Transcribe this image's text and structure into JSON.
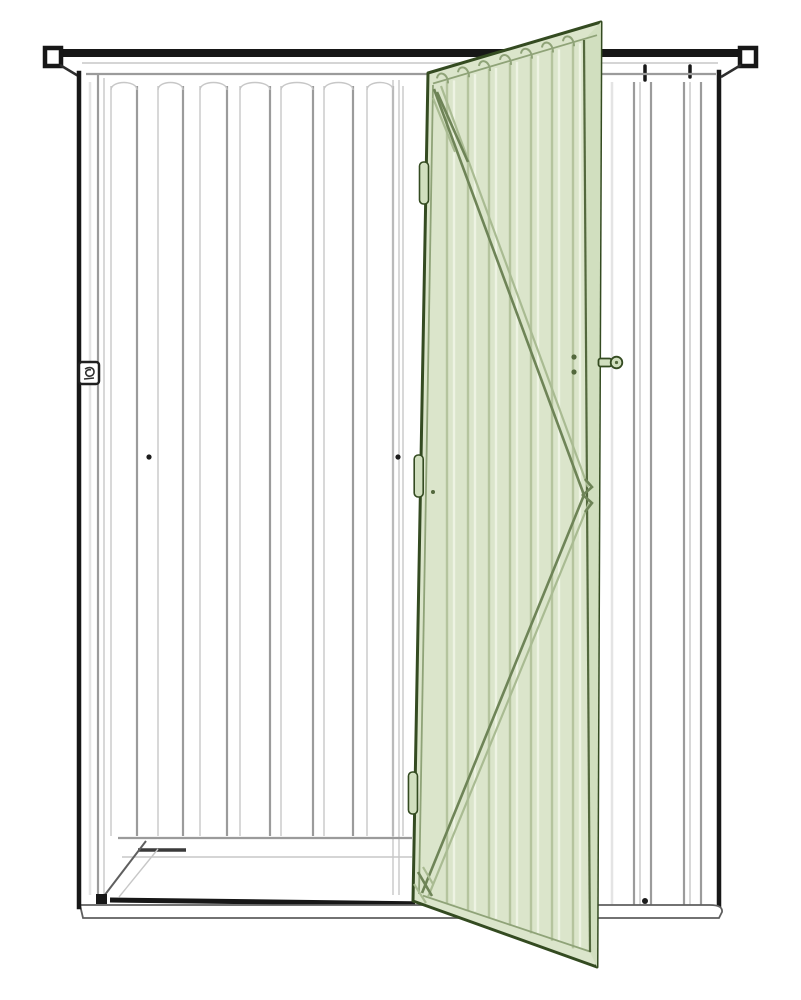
{
  "illustration": {
    "subject": "metal-garden-shed-front-view",
    "door_state": "open",
    "door_color_name": "sage-green",
    "style": "sketch-line-drawing"
  },
  "colors": {
    "paper": "#ffffff",
    "ink": "#171717",
    "line_faint": "#e4e4e4",
    "line_light": "#c7c7c7",
    "line_mid": "#9b9b9b",
    "line_dark": "#5f5f5f",
    "door_fill": "#dbe5cb",
    "door_edge_fill": "#d1dfbf",
    "door_outline": "#344b21",
    "door_stile": "#53683d",
    "door_rib": "#b5c49e",
    "door_rib_hi": "#eef3e3",
    "door_rib_dk": "#8fa378",
    "brace": "#6e8457",
    "brace_hi": "#a9bb92"
  },
  "geometry": {
    "canvas": {
      "width": 801,
      "height": 1000
    },
    "interior": {
      "rib_top_y": 86,
      "rib_bottom_y": 836,
      "ribs": [
        [
          111,
          1
        ],
        [
          137,
          2
        ],
        [
          158,
          1
        ],
        [
          183,
          2
        ],
        [
          200,
          1
        ],
        [
          227,
          2
        ],
        [
          240,
          1
        ],
        [
          270,
          2
        ],
        [
          281,
          1
        ],
        [
          313,
          2
        ],
        [
          324,
          1
        ],
        [
          353,
          2
        ],
        [
          367,
          1
        ],
        [
          393,
          2
        ],
        [
          403,
          1
        ]
      ],
      "arc_pairs": [
        [
          111,
          137
        ],
        [
          158,
          183
        ],
        [
          200,
          227
        ],
        [
          240,
          270
        ],
        [
          281,
          313
        ],
        [
          324,
          353
        ],
        [
          367,
          393
        ]
      ],
      "dots": [
        [
          149,
          457
        ],
        [
          398,
          457
        ]
      ]
    },
    "right_wall": {
      "rib_top_y": 82,
      "rib_bottom_y": 905,
      "ribs": [
        [
          612,
          0
        ],
        [
          634,
          2
        ],
        [
          640,
          1
        ],
        [
          651,
          2
        ],
        [
          684,
          2
        ],
        [
          690,
          1
        ],
        [
          701,
          2
        ]
      ],
      "top_ticks": [
        [
          645,
          66,
          80
        ],
        [
          690,
          66,
          77
        ]
      ],
      "dot": [
        645,
        901
      ]
    },
    "door": {
      "corners": {
        "top_left": [
          428,
          73
        ],
        "top_right": [
          601,
          22
        ],
        "bottom_left": [
          413,
          901
        ],
        "bottom_right": [
          597,
          967
        ]
      },
      "ribs_x": [
        447,
        468,
        489,
        510,
        531,
        552,
        573
      ],
      "stile": {
        "top": [
          584,
          40
        ],
        "bottom": [
          590,
          952
        ]
      },
      "brace_apex": [
        584,
        495
      ],
      "hinges_y": [
        [
          162,
          204
        ],
        [
          455,
          497
        ],
        [
          772,
          814
        ]
      ],
      "knob": {
        "cx": 616.5,
        "cy": 362.5,
        "r": 5.8
      },
      "face_dots": [
        [
          574,
          357
        ],
        [
          574,
          372
        ]
      ],
      "screw": [
        433,
        492
      ]
    }
  }
}
